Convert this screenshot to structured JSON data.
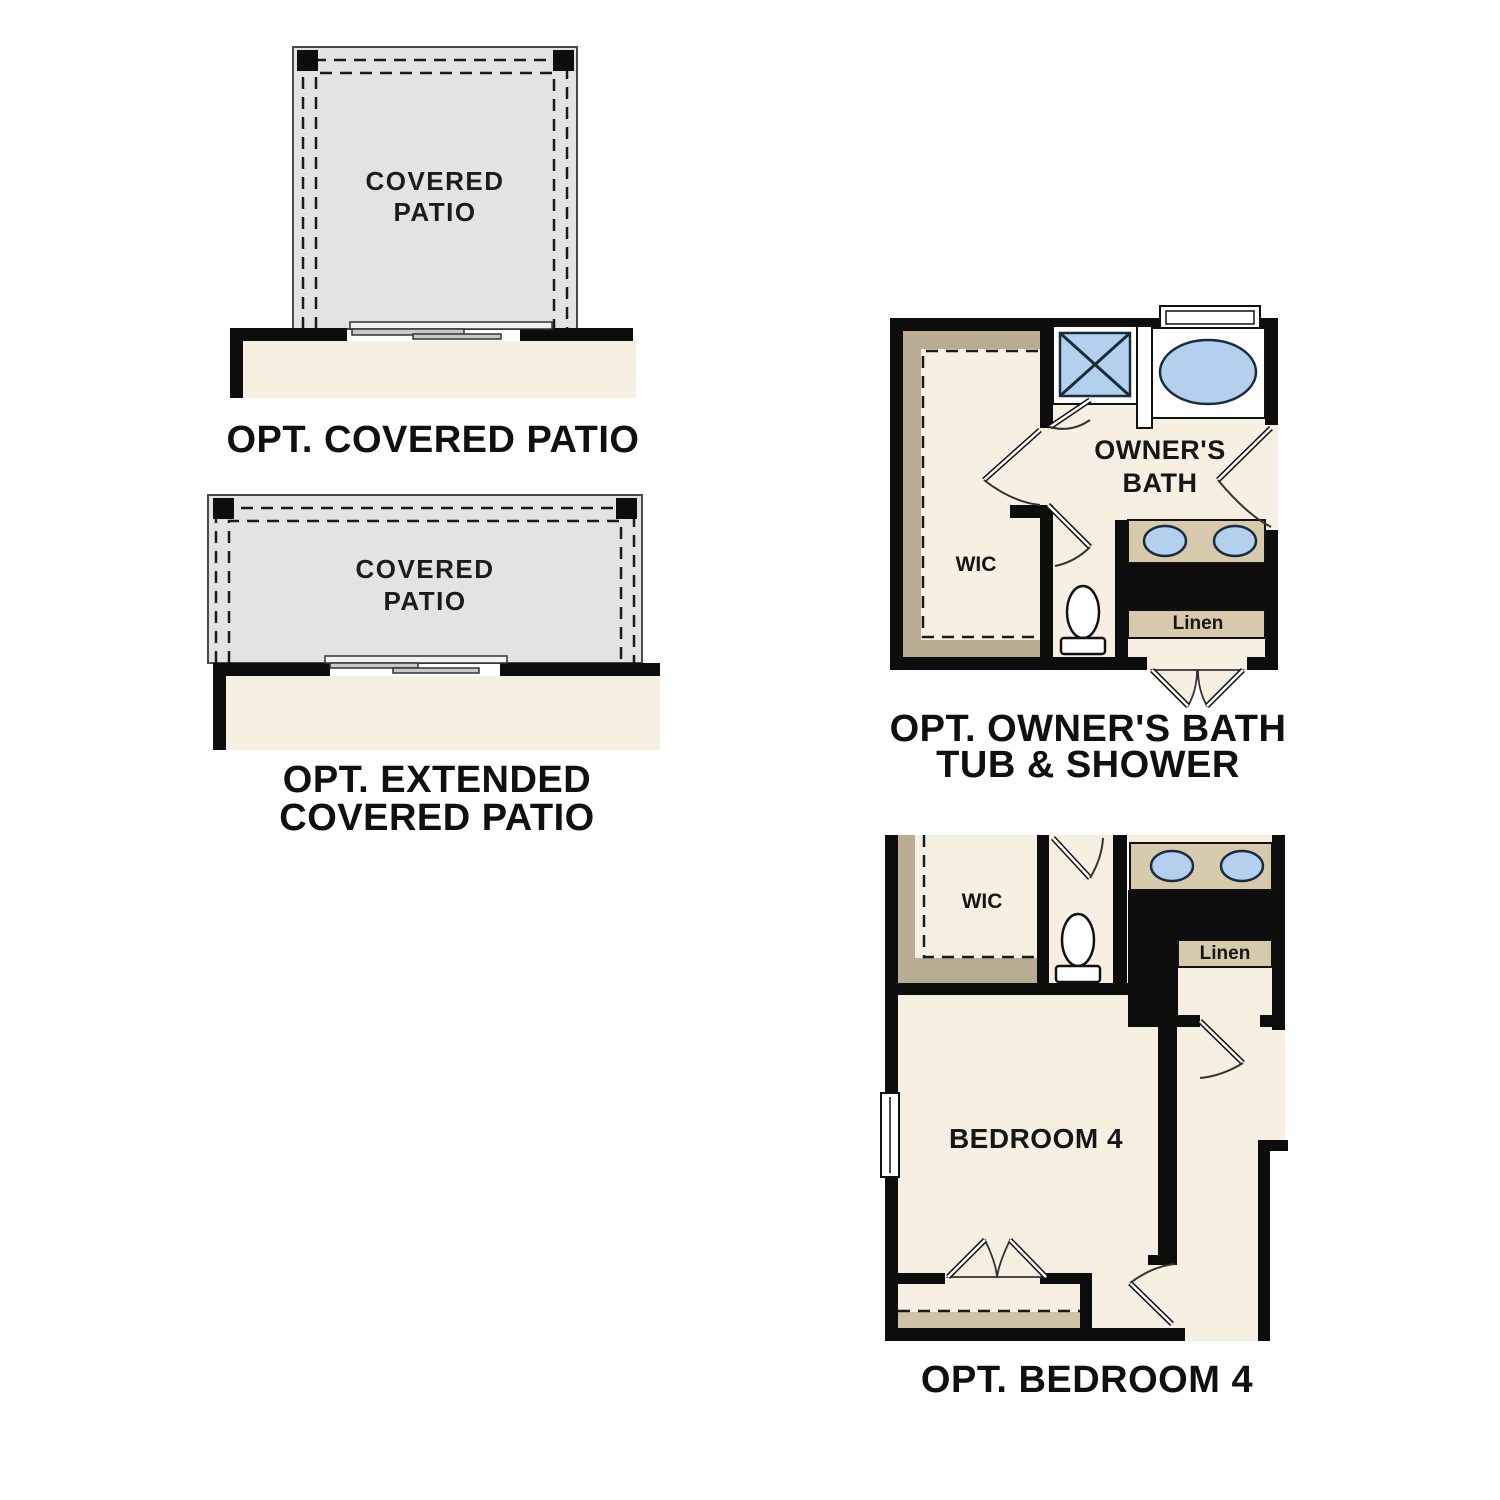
{
  "colors": {
    "background": "#ffffff",
    "wall_black": "#0d0d0d",
    "floor_cream": "#f7f0e2",
    "patio_gray": "#e3e3e1",
    "shelf_tan": "#b9ac92",
    "counter_tan": "#d7c9ab",
    "closet_shelf_tan": "#cfc2a5",
    "fixture_blue": "#b3d1ee",
    "fixture_outline": "#1c2b3a"
  },
  "covered_patio": {
    "room_label": [
      "COVERED",
      "PATIO"
    ],
    "caption": [
      "OPT. COVERED PATIO"
    ]
  },
  "extended_patio": {
    "room_label": [
      "COVERED",
      "PATIO"
    ],
    "caption": [
      "OPT. EXTENDED",
      "COVERED PATIO"
    ]
  },
  "owners_bath": {
    "room_label": [
      "OWNER'S",
      "BATH"
    ],
    "closet_label": "WIC",
    "linen_label": "Linen",
    "caption": [
      "OPT. OWNER'S BATH",
      "TUB & SHOWER"
    ]
  },
  "bedroom4": {
    "closet_label": "WIC",
    "linen_label": "Linen",
    "room_label": "BEDROOM 4",
    "caption": [
      "OPT. BEDROOM 4"
    ]
  }
}
